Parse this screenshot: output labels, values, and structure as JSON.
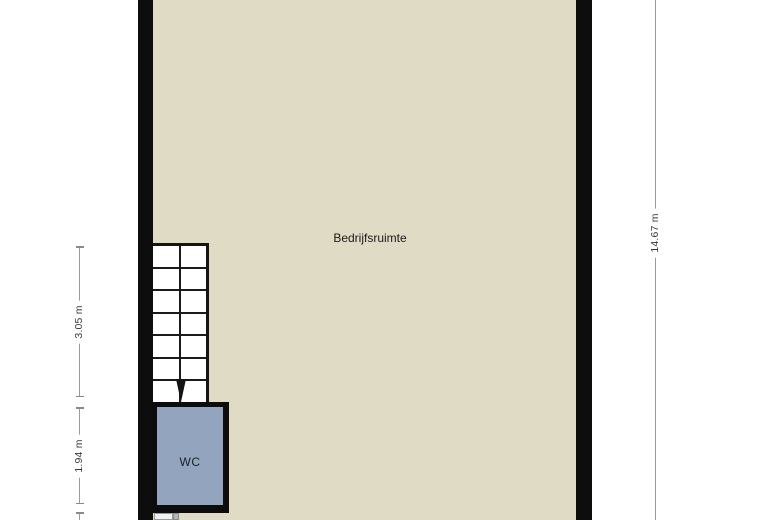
{
  "plan": {
    "room_label": "Bedrijfsruimte",
    "wc_label": "WC",
    "dimensions": {
      "stairs_height": "3.05 m",
      "wc_height": "1.94 m",
      "building_height": "14.67 m"
    },
    "stairs": {
      "rows": 7,
      "columns": 2,
      "direction": "down"
    },
    "colors": {
      "floor": "#E0DBC5",
      "wall": "#0D0D0D",
      "wc_fill": "#93A4BE",
      "stair_line": "#1A1A1A",
      "dimension_line": "#9A9A9A",
      "dimension_text": "#3A3A3A"
    }
  }
}
